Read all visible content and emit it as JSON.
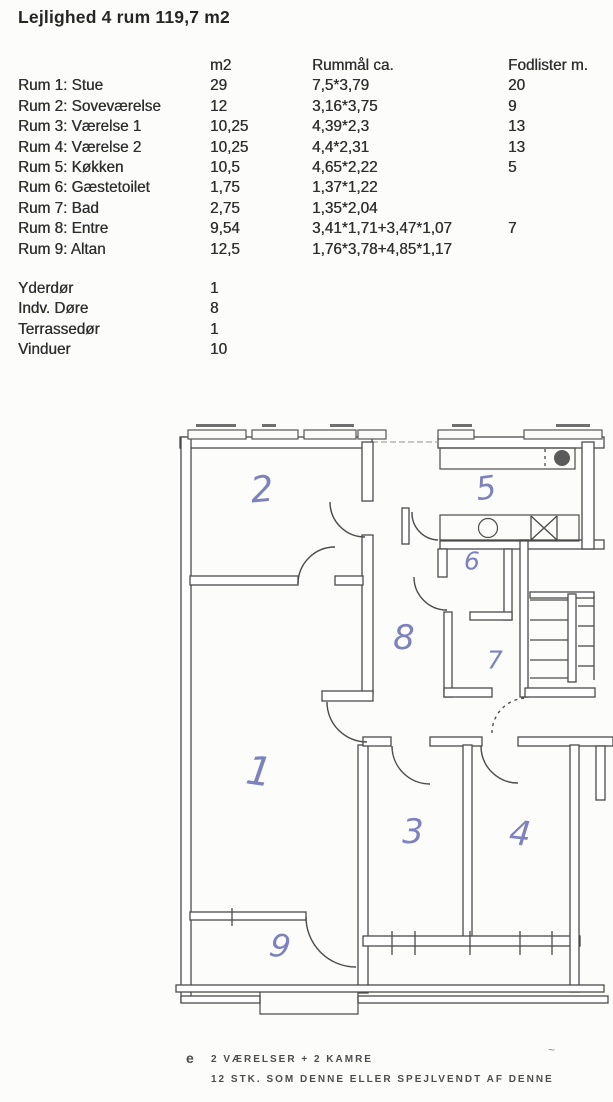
{
  "title": "Lejlighed 4 rum 119,7 m2",
  "table": {
    "headers": [
      "",
      "m2",
      "Rummål ca.",
      "Fodlister m."
    ],
    "rows": [
      {
        "label": "Rum 1: Stue",
        "m2": "29",
        "dim": "7,5*3,79",
        "fod": "20"
      },
      {
        "label": "Rum 2: Soveværelse",
        "m2": "12",
        "dim": "3,16*3,75",
        "fod": "9"
      },
      {
        "label": "Rum 3: Værelse 1",
        "m2": "10,25",
        "dim": "4,39*2,3",
        "fod": "13"
      },
      {
        "label": "Rum 4: Værelse 2",
        "m2": "10,25",
        "dim": "4,4*2,31",
        "fod": "13"
      },
      {
        "label": "Rum 5: Køkken",
        "m2": "10,5",
        "dim": "4,65*2,22",
        "fod": "5"
      },
      {
        "label": "Rum 6: Gæstetoilet",
        "m2": "1,75",
        "dim": "1,37*1,22",
        "fod": ""
      },
      {
        "label": "Rum 7: Bad",
        "m2": "2,75",
        "dim": "1,35*2,04",
        "fod": ""
      },
      {
        "label": "Rum 8: Entre",
        "m2": "9,54",
        "dim": "3,41*1,71+3,47*1,07",
        "fod": "7"
      },
      {
        "label": "Rum 9: Altan",
        "m2": "12,5",
        "dim": "1,76*3,78+4,85*1,17",
        "fod": ""
      }
    ]
  },
  "extras": [
    {
      "label": "Yderdør",
      "value": "1"
    },
    {
      "label": "Indv. Døre",
      "value": "8"
    },
    {
      "label": "Terrassedør",
      "value": "1"
    },
    {
      "label": "Vinduer",
      "value": "10"
    }
  ],
  "plan": {
    "rooms": [
      "1",
      "2",
      "3",
      "4",
      "5",
      "6",
      "7",
      "8",
      "9"
    ]
  },
  "caption": {
    "marker": "e",
    "line1": "2 VÆRELSER + 2 KAMRE",
    "line2": "12 STK. SOM DENNE ELLER SPEJLVENDT AF DENNE",
    "stray": "~"
  },
  "colors": {
    "handwriting": "#7d82bd",
    "ink": "#4b4b4b"
  }
}
